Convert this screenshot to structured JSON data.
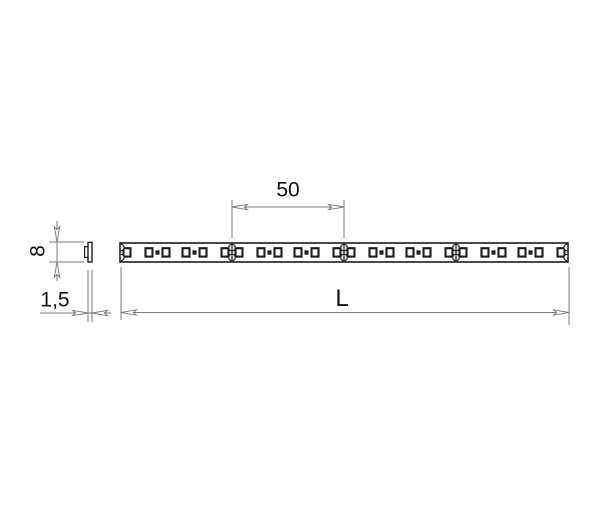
{
  "figure": {
    "type": "technical-drawing",
    "background_color": "#ffffff",
    "dimension_line_color": "#7a7a7a",
    "part_line_color": "#1c1c1c",
    "text_color": "#111111",
    "labels": {
      "led_pitch_mm": "50",
      "strip_width_mm": "8",
      "strip_thickness_mm": "1,5",
      "strip_length": "L"
    },
    "strip": {
      "segments": 4,
      "leds_per_segment": 6,
      "resistor_dots_per_segment": 2,
      "interior_cut_points": 3,
      "end_notches_per_end": 2
    }
  }
}
